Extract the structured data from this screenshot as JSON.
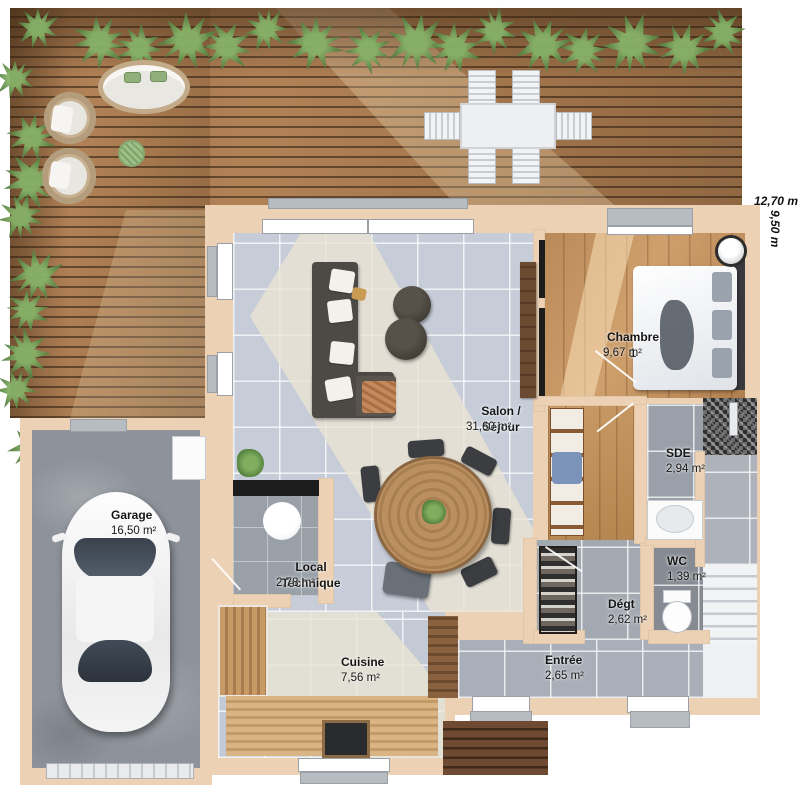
{
  "plan": {
    "title": "Plan de maison - rez-de-chaussée",
    "dimensions": {
      "width": "12,70 m",
      "height": "9,50 m"
    },
    "rooms": [
      {
        "id": "salon",
        "label": "Salon / Séjour",
        "area": "31,60 m²"
      },
      {
        "id": "chambre1",
        "label": "Chambre 1",
        "area": "9,67 m²"
      },
      {
        "id": "sde",
        "label": "SDE",
        "area": "2,94 m²"
      },
      {
        "id": "wc",
        "label": "WC",
        "area": "1,39 m²"
      },
      {
        "id": "degt",
        "label": "Dégt",
        "area": "2,62 m²"
      },
      {
        "id": "entree",
        "label": "Entrée",
        "area": "2,65 m²"
      },
      {
        "id": "cuisine",
        "label": "Cuisine",
        "area": "7,56 m²"
      },
      {
        "id": "local",
        "label": "Local Technique",
        "area": "2,78 m²"
      },
      {
        "id": "garage",
        "label": "Garage",
        "area": "16,50 m²"
      }
    ],
    "colors": {
      "wall": "#ecd1b5",
      "deck_wood": "#a87c52",
      "tile_floor": "#c6cdd9",
      "bedroom_wood": "#c49463",
      "concrete": "#8e939b",
      "plant_green": "#5d8747"
    }
  }
}
